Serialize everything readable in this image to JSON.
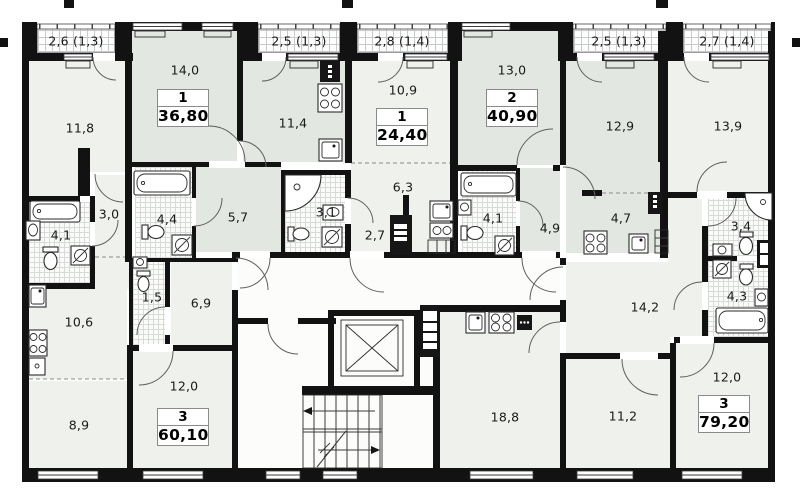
{
  "balconies": [
    {
      "label": "2,6 (1,3)"
    },
    {
      "label": "2,5 (1,3)"
    },
    {
      "label": "2,8 (1,4)"
    },
    {
      "label": "2,5 (1,3)"
    },
    {
      "label": "2,7 (1,4)"
    }
  ],
  "apartments": [
    {
      "number": "3",
      "area": "60,10",
      "rooms": [
        {
          "label": "11,8"
        },
        {
          "label": "3,0"
        },
        {
          "label": "4,1"
        },
        {
          "label": "10,6"
        },
        {
          "label": "1,5"
        },
        {
          "label": "6,9"
        },
        {
          "label": "12,0"
        },
        {
          "label": "8,9"
        }
      ]
    },
    {
      "number": "1",
      "area": "36,80",
      "rooms": [
        {
          "label": "14,0"
        },
        {
          "label": "11,4"
        },
        {
          "label": "5,7"
        },
        {
          "label": "4,4"
        }
      ]
    },
    {
      "number": "1",
      "area": "24,40",
      "rooms": [
        {
          "label": "10,9"
        },
        {
          "label": "6,3"
        },
        {
          "label": "3,1"
        },
        {
          "label": "2,7"
        }
      ]
    },
    {
      "number": "2",
      "area": "40,90",
      "rooms": [
        {
          "label": "13,0"
        },
        {
          "label": "12,9"
        },
        {
          "label": "4,9"
        },
        {
          "label": "4,7"
        },
        {
          "label": "4,1"
        }
      ]
    },
    {
      "number": "3",
      "area": "79,20",
      "rooms": [
        {
          "label": "13,9"
        },
        {
          "label": "14,2"
        },
        {
          "label": "3,4"
        },
        {
          "label": "4,3"
        },
        {
          "label": "18,8"
        },
        {
          "label": "11,2"
        },
        {
          "label": "12,0"
        }
      ]
    }
  ],
  "symbols": [
    "bathtub",
    "shower",
    "toilet",
    "sink",
    "stove",
    "oven",
    "cooker-hood",
    "washing-machine",
    "elevator",
    "staircase",
    "door-swing",
    "window",
    "vent-shaft",
    "balcony-hatch"
  ],
  "colors": {
    "wall": "#121212",
    "room_light": "#eef1ec",
    "room_shaded": "#e3e7e2",
    "corridor": "#fcfdfb",
    "tile_grid": "#d7dbd7",
    "hatch_grid": "#c7cbc7"
  }
}
